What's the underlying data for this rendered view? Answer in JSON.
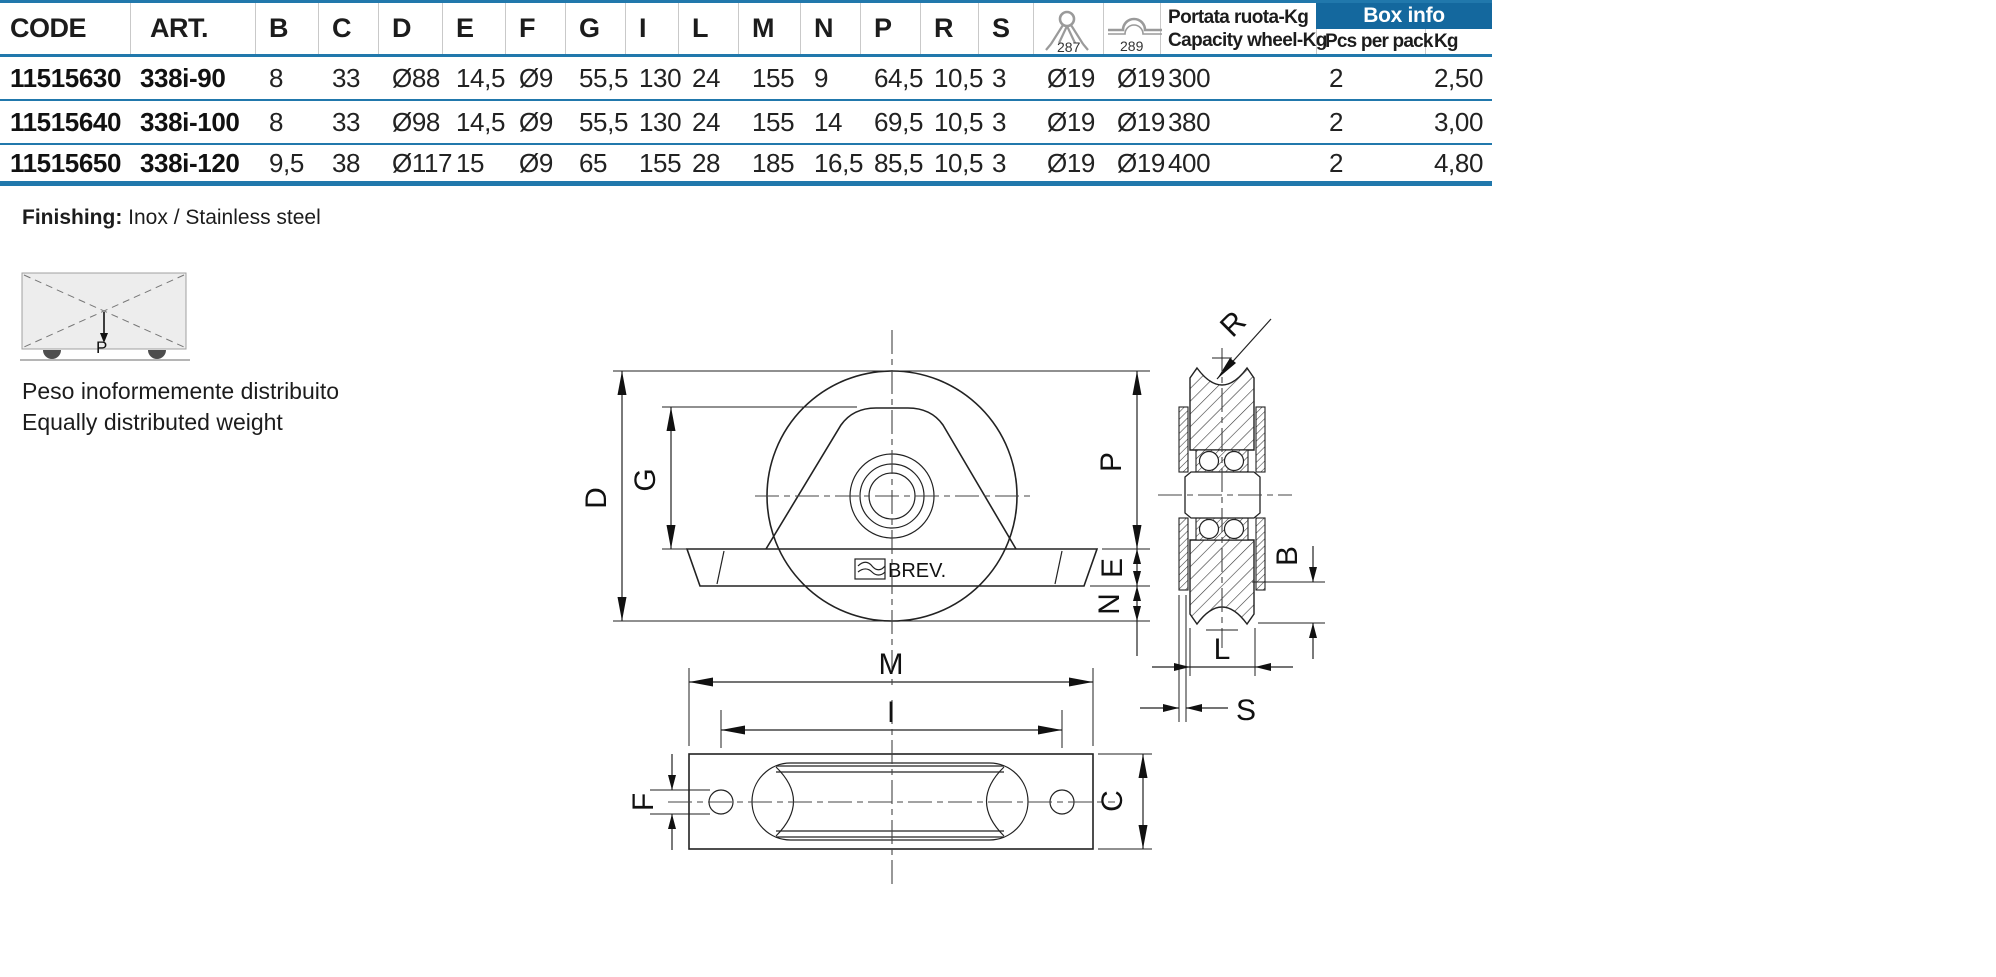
{
  "table": {
    "headers": {
      "code": "CODE",
      "art": "ART.",
      "dims": [
        "B",
        "C",
        "D",
        "E",
        "F",
        "G",
        "I",
        "L",
        "M",
        "N",
        "P",
        "R",
        "S"
      ],
      "icon1_num": "287",
      "icon2_num": "289",
      "capacity_line1": "Portata ruota-Kg",
      "capacity_line2": "Capacity wheel-Kg",
      "box_info": "Box info",
      "pcs": "Pcs per pack",
      "kg": "Kg"
    },
    "rows": [
      {
        "code": "11515630",
        "art": "338i-90",
        "values": [
          "8",
          "33",
          "Ø88",
          "14,5",
          "Ø9",
          "55,5",
          "130",
          "24",
          "155",
          "9",
          "64,5",
          "10,5",
          "3",
          "Ø19",
          "Ø19"
        ],
        "capacity": "300",
        "pcs": "2",
        "kg": "2,50"
      },
      {
        "code": "11515640",
        "art": "338i-100",
        "values": [
          "8",
          "33",
          "Ø98",
          "14,5",
          "Ø9",
          "55,5",
          "130",
          "24",
          "155",
          "14",
          "69,5",
          "10,5",
          "3",
          "Ø19",
          "Ø19"
        ],
        "capacity": "380",
        "pcs": "2",
        "kg": "3,00"
      },
      {
        "code": "11515650",
        "art": "338i-120",
        "values": [
          "9,5",
          "38",
          "Ø117",
          "15",
          "Ø9",
          "65",
          "155",
          "28",
          "185",
          "16,5",
          "85,5",
          "10,5",
          "3",
          "Ø19",
          "Ø19"
        ],
        "capacity": "400",
        "pcs": "2",
        "kg": "4,80"
      }
    ]
  },
  "finishing": {
    "label": "Finishing:",
    "value": " Inox / Stainless steel"
  },
  "weight_note": {
    "line1": "Peso inoformemente distribuito",
    "line2": "Equally distributed weight",
    "arrow_label": "P"
  },
  "drawing": {
    "brand": "BREV.",
    "labels": {
      "D": "D",
      "G": "G",
      "P": "P",
      "E": "E",
      "N": "N",
      "M": "M",
      "I": "I",
      "F": "F",
      "C": "C",
      "R": "R",
      "B": "B",
      "L": "L",
      "S": "S"
    }
  },
  "colors": {
    "accent_blue": "#14689e",
    "line_blue": "#2178ac",
    "icon_gray": "#9a9a9a"
  }
}
